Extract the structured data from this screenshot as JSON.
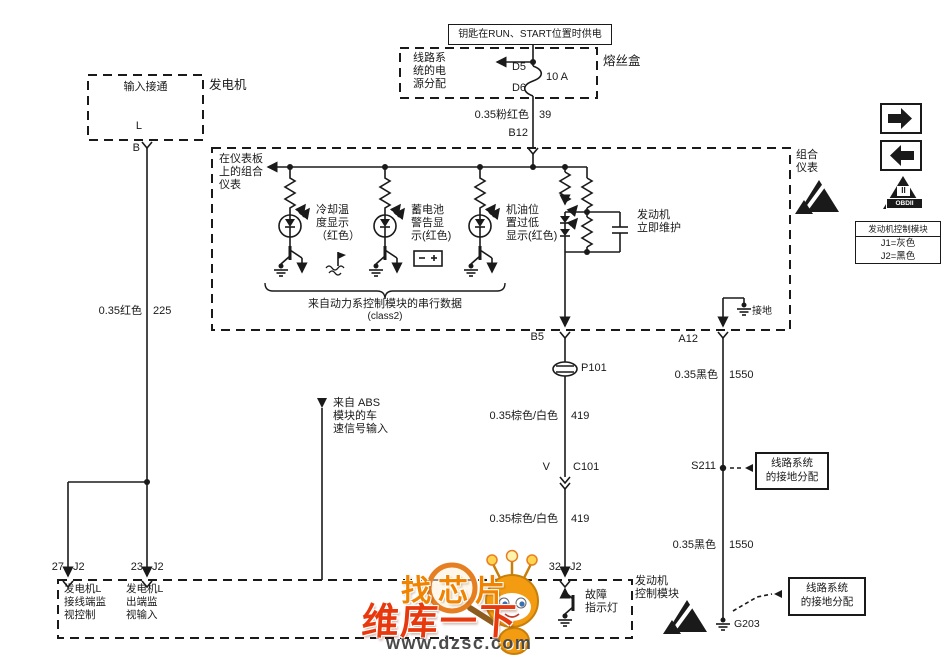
{
  "top": {
    "key_power": "钥匙在RUN、START位置时供电",
    "fusebox_name": "熔丝盒",
    "power_dist": "线路系\n统的电\n源分配",
    "pin_d5": "D5",
    "pin_d6": "D6",
    "fuse_rating": "10 A"
  },
  "wire_pink": {
    "label": "0.35粉红色",
    "num": "39"
  },
  "conn_b12": "B12",
  "generator": {
    "name": "发电机",
    "box": "输入接通",
    "pin_l": "L",
    "pin_b": "B"
  },
  "wire_red": {
    "label": "0.35红色",
    "num": "225"
  },
  "cluster": {
    "name": "组合\n仪表",
    "panel_note": "在仪表板\n上的组合\n仪表",
    "lamp_coolant": "冷却温\n度显示\n（红色）",
    "lamp_battery": "蓄电池\n警告显\n示(红色)",
    "lamp_oil": "机油位\n置过低\n显示(红色)",
    "service_now": "发动机\n立即维护",
    "serial_note": "来自动力系控制模块的串行数据",
    "serial_class": "(class2)",
    "ground": "接地",
    "conn_b5": "B5",
    "conn_a12": "A12"
  },
  "middle": {
    "conn_p101": "P101",
    "wire_brown1": {
      "label": "0.35棕色/白色",
      "num": "419"
    },
    "pin_v": "V",
    "conn_c101": "C101",
    "wire_brown2": {
      "label": "0.35棕色/白色",
      "num": "419"
    },
    "abs_note": "来自 ABS\n模块的车\n速信号输入"
  },
  "right": {
    "wire_black1": {
      "label": "0.35黑色",
      "num": "1550"
    },
    "splice": "S211",
    "ground_box1": "线路系统\n的接地分配",
    "wire_black2": {
      "label": "0.35黑色",
      "num": "1550"
    },
    "ground_g203": "G203",
    "ground_box2": "线路系统\n的接地分配"
  },
  "bottom": {
    "pin27": "27",
    "j2a": "J2",
    "pin23": "23",
    "j2b": "J2",
    "pin32": "32",
    "j2c": "J2",
    "gen_l_ctrl": "发电机L\n接线端监\n视控制",
    "gen_l_out": "发电机L\n出端监\n视输入",
    "fault_lamp": "故障\n指示灯",
    "ecm": "发动机\n控制模块"
  },
  "side": {
    "obd_top": "II",
    "obd_band": "OBDII",
    "legend_title": "发动机控制模块",
    "legend_j1": "J1=灰色",
    "legend_j2": "J2=黑色"
  },
  "watermark": {
    "find": "找芯片",
    "brand": "维库一下",
    "url": "www.dzsc.com"
  },
  "colors": {
    "ink": "#1a1a1a",
    "wm_orange": "#f08300",
    "wm_red": "#e8380d",
    "url_gray": "#4a4a4a"
  }
}
